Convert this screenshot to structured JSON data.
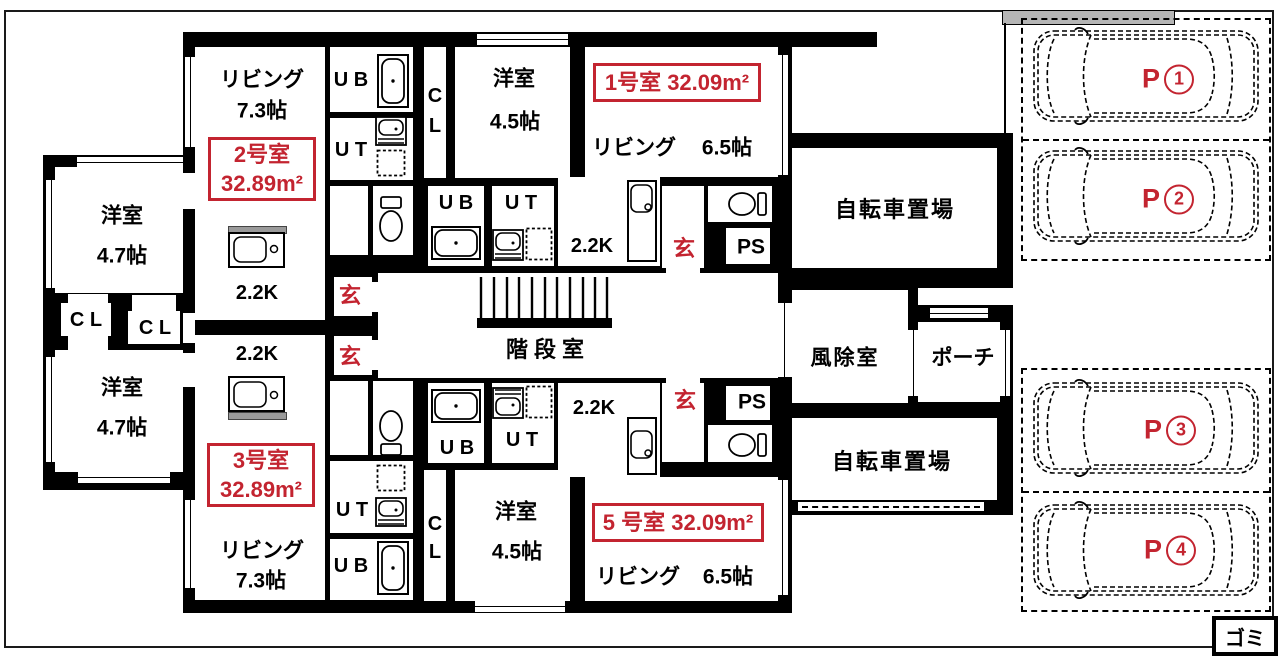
{
  "colors": {
    "accent_red": "#c32430",
    "wall": "#000000",
    "site_gray": "#b5b5b5",
    "counter_gray": "#9a9a9a"
  },
  "units": {
    "unit1": {
      "tag": "1号室 32.09m²",
      "living_label": "リビング",
      "living_size": "6.5帖",
      "bedroom_label": "洋室",
      "bedroom_size": "4.5帖",
      "kitchen": "2.2K",
      "entrance": "玄",
      "pipe_space": "PS",
      "unit_bath": "U B",
      "utility": "U T",
      "closet_c": "C",
      "closet_l": "L"
    },
    "unit2": {
      "tag_name": "2号室",
      "tag_area": "32.89m²",
      "living_label": "リビング",
      "living_size": "7.3帖",
      "kitchen": "2.2K",
      "entrance": "玄",
      "unit_bath": "U B",
      "utility": "U T"
    },
    "unit3": {
      "tag_name": "3号室",
      "tag_area": "32.89m²",
      "living_label": "リビング",
      "living_size": "7.3帖",
      "kitchen": "2.2K",
      "entrance": "玄",
      "unit_bath": "U B",
      "utility": "U T"
    },
    "unit5": {
      "tag": "5 号室 32.09m²",
      "living_label": "リビング",
      "living_size": "6.5帖",
      "bedroom_label": "洋室",
      "bedroom_size": "4.5帖",
      "kitchen": "2.2K",
      "entrance": "玄",
      "pipe_space": "PS",
      "unit_bath": "U B",
      "utility": "U T",
      "closet_c": "C",
      "closet_l": "L"
    }
  },
  "west_wing": {
    "bedroom_top_label": "洋室",
    "bedroom_top_size": "4.7帖",
    "closet_left": "C L",
    "closet_right": "C L",
    "bedroom_bottom_label": "洋室",
    "bedroom_bottom_size": "4.7帖"
  },
  "common": {
    "stairwell": "階段室",
    "windbreak_room": "風除室",
    "porch": "ポーチ",
    "bicycle_parking_top": "自転車置場",
    "bicycle_parking_bottom": "自転車置場",
    "garbage": "ゴミ"
  },
  "parking": {
    "stalls": [
      {
        "prefix": "P",
        "number": "1"
      },
      {
        "prefix": "P",
        "number": "2"
      },
      {
        "prefix": "P",
        "number": "3"
      },
      {
        "prefix": "P",
        "number": "4"
      }
    ]
  }
}
